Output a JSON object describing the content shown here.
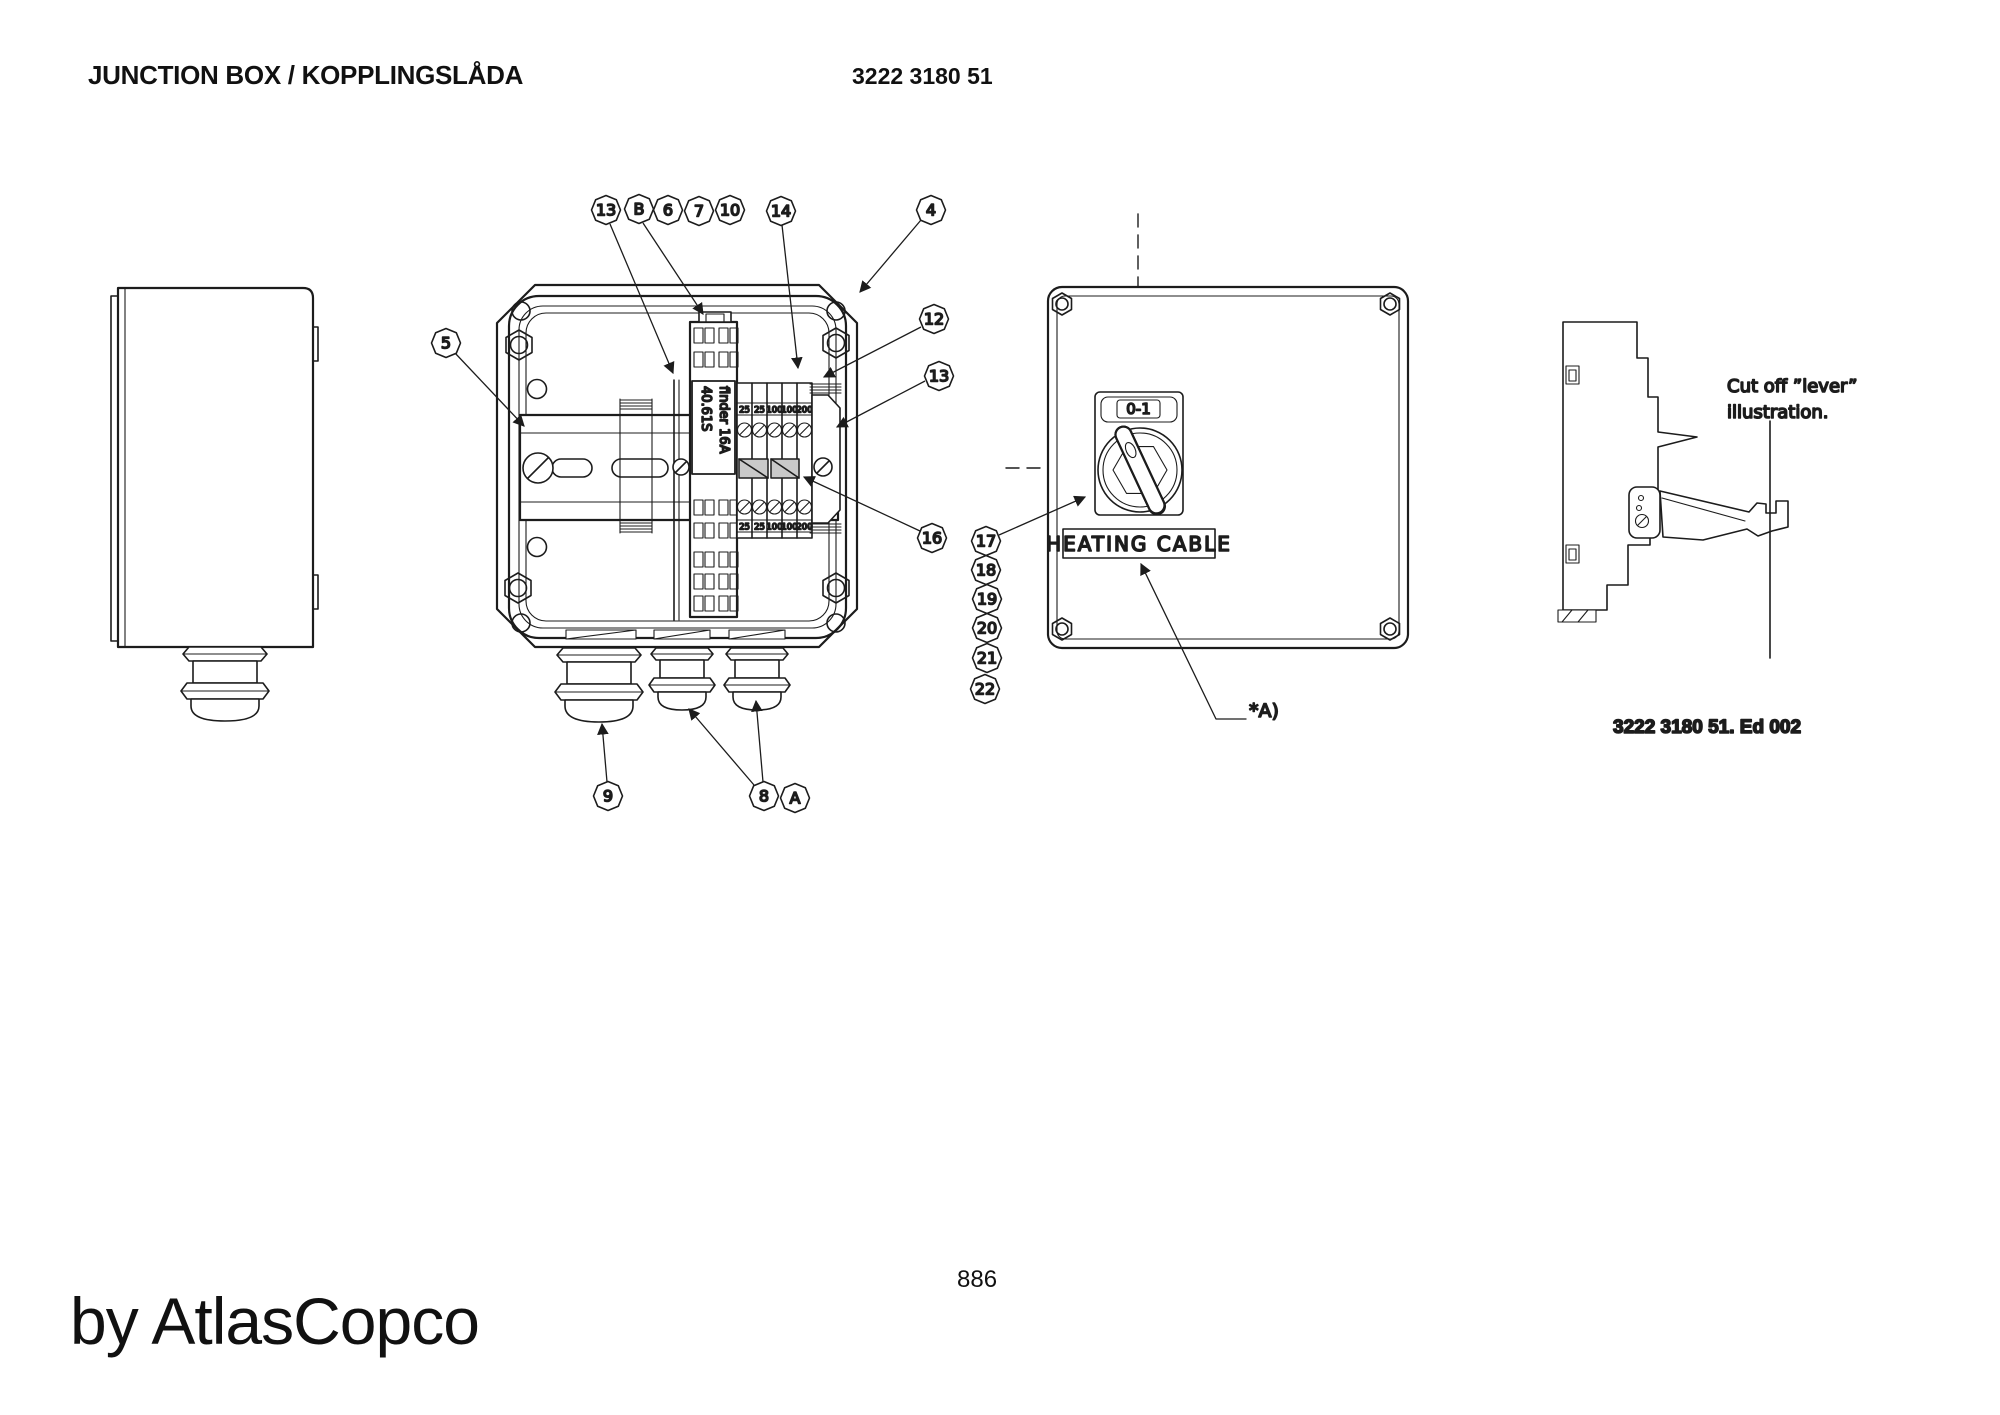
{
  "header": {
    "title": "JUNCTION BOX / KOPPLINGSLÅDA",
    "part_number": "3222 3180 51"
  },
  "callouts": {
    "c13a": "13",
    "cB": "B",
    "c6": "6",
    "c7": "7",
    "c10": "10",
    "c14": "14",
    "c4": "4",
    "c5": "5",
    "c12": "12",
    "c13b": "13",
    "c16": "16",
    "c9": "9",
    "c8": "8",
    "cA": "A",
    "c17": "17",
    "c18": "18",
    "c19": "19",
    "c20": "20",
    "c21": "21",
    "c22": "22"
  },
  "open_box_view": {
    "relay_label_line1": "finder 16A",
    "relay_label_line2": "40.61S",
    "terminal_labels_top": [
      "25",
      "25",
      "100",
      "100",
      "200"
    ],
    "terminal_labels_bottom": [
      "25",
      "25",
      "100",
      "100",
      "200"
    ]
  },
  "front_view": {
    "switch_label": "0-1",
    "panel_label": "HEATING CABLE",
    "footnote": "*A)"
  },
  "lever_view": {
    "caption_line1": "Cut off ”lever”",
    "caption_line2": "illustration.",
    "edition": "3222 3180 51. Ed 002"
  },
  "footer": {
    "page_number": "886",
    "brand": "by AtlasCopco"
  },
  "colors": {
    "line": "#1c1c1c",
    "jumper_fill": "#c9c9c9",
    "background": "#ffffff"
  }
}
